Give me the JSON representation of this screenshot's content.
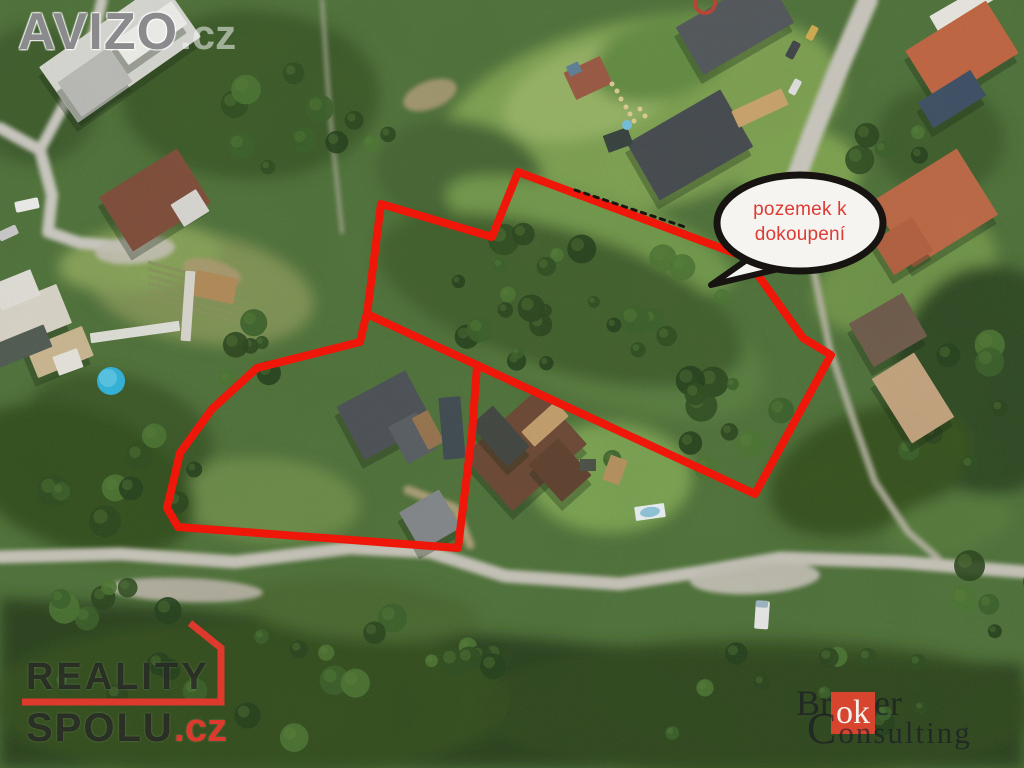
{
  "image": {
    "width": 1024,
    "height": 768,
    "description": "Aerial photo of land parcels for sale"
  },
  "callout": {
    "line1": "pozemek k",
    "line2": "dokoupení",
    "text_color": "#dc3c33",
    "fill": "#f6f4f1",
    "border_color": "#161311",
    "ellipse": [
      800,
      223,
      83,
      48
    ],
    "tail": [
      [
        748,
        259
      ],
      [
        711,
        285
      ],
      [
        783,
        268
      ]
    ]
  },
  "annotation": {
    "outline_color": "#ee1709",
    "outline_width": 8,
    "upper_parcel": [
      [
        518,
        172
      ],
      [
        745,
        257
      ],
      [
        803,
        338
      ],
      [
        831,
        355
      ],
      [
        755,
        494
      ],
      [
        367,
        314
      ],
      [
        381,
        204
      ],
      [
        492,
        237
      ]
    ],
    "lower_parcel": [
      [
        366,
        316
      ],
      [
        360,
        342
      ],
      [
        257,
        368
      ],
      [
        212,
        409
      ],
      [
        180,
        453
      ],
      [
        167,
        508
      ],
      [
        178,
        527
      ],
      [
        458,
        548
      ],
      [
        472,
        434
      ],
      [
        477,
        366
      ]
    ],
    "boundary_ticks": {
      "points": [
        [
          575,
          190
        ],
        [
          688,
          228
        ]
      ],
      "color": "#1a1712"
    }
  },
  "watermarks": {
    "avizo": {
      "name": "AVIZO",
      "tld": ".cz"
    },
    "reality_spolu": {
      "line1": "REALITY",
      "line2": "SPOLU",
      "tld": ".cz",
      "accent": "#dd392c",
      "mark": [
        [
          190,
          623
        ],
        [
          221,
          648
        ],
        [
          221,
          702
        ],
        [
          22,
          702
        ]
      ]
    },
    "broker_consulting": {
      "pre": "Br",
      "highlight": "ok",
      "post": "er",
      "line2_initial": "C",
      "line2_rest": "onsulting",
      "box_color": "#d7452f"
    }
  },
  "scene": {
    "base": "#4e7138",
    "tree_palette": [
      "#24401b",
      "#2d4d1f",
      "#3a5f28",
      "#4a7331",
      "#2a451d"
    ],
    "tree_highlight": "#5d8038",
    "blobs": [
      {
        "e": [
          640,
          115,
          205,
          95,
          -12
        ],
        "c": "#7ca04f"
      },
      {
        "e": [
          595,
          90,
          95,
          45,
          -18
        ],
        "c": "#95b264"
      },
      {
        "e": [
          250,
          95,
          130,
          85,
          0
        ],
        "c": "#3b5a28"
      },
      {
        "e": [
          35,
          95,
          65,
          70,
          0
        ],
        "c": "#3d5c2a"
      },
      {
        "e": [
          460,
          175,
          85,
          55,
          10
        ],
        "c": "#456530"
      },
      {
        "e": [
          590,
          235,
          150,
          42,
          17
        ],
        "c": "#6f9749"
      },
      {
        "e": [
          600,
          330,
          175,
          72,
          20
        ],
        "c": "#567b3c"
      },
      {
        "e": [
          560,
          300,
          190,
          70,
          17
        ],
        "c": "#3f5f2a"
      },
      {
        "e": [
          610,
          478,
          82,
          55,
          0
        ],
        "c": "#79a150"
      },
      {
        "e": [
          905,
          275,
          95,
          52,
          -20
        ],
        "c": "#6e9346"
      },
      {
        "e": [
          800,
          175,
          60,
          45,
          -10
        ],
        "c": "#7ba14e"
      },
      {
        "e": [
          200,
          288,
          115,
          55,
          10
        ],
        "c": "#7e9252"
      },
      {
        "e": [
          140,
          258,
          82,
          32,
          -8
        ],
        "c": "#86a156"
      },
      {
        "e": [
          268,
          500,
          92,
          42,
          5
        ],
        "c": "#6b8b47"
      },
      {
        "e": [
          120,
          430,
          95,
          55,
          15
        ],
        "c": "#3a5826"
      },
      {
        "e": [
          80,
          480,
          120,
          70,
          20
        ],
        "c": "#33501f"
      },
      {
        "p": [
          [
            0,
            598
          ],
          [
            150,
            606
          ],
          [
            350,
            622
          ],
          [
            600,
            645
          ],
          [
            850,
            655
          ],
          [
            1024,
            665
          ],
          [
            1024,
            768
          ],
          [
            0,
            768
          ]
        ],
        "c": "#2b421f"
      },
      {
        "e": [
          250,
          700,
          260,
          80,
          0
        ],
        "c": "#35511f",
        "o": 0.75
      },
      {
        "e": [
          760,
          708,
          280,
          70,
          0
        ],
        "c": "#31491e",
        "o": 0.75
      },
      {
        "e": [
          990,
          380,
          95,
          115,
          0
        ],
        "c": "#2f4a20"
      },
      {
        "e": [
          870,
          470,
          105,
          60,
          -20
        ],
        "c": "#34511f"
      },
      {
        "e": [
          940,
          140,
          65,
          55,
          0
        ],
        "c": "#3e5d2a"
      },
      {
        "e": [
          660,
          60,
          70,
          40,
          -15
        ],
        "c": "#628b41"
      },
      {
        "e": [
          950,
          525,
          65,
          28,
          -12
        ],
        "c": "#55793a"
      },
      {
        "e": [
          360,
          610,
          120,
          30,
          5
        ],
        "c": "#49682f"
      }
    ],
    "roads": [
      {
        "pts": [
          [
            0,
            557
          ],
          [
            120,
            554
          ],
          [
            235,
            562
          ],
          [
            350,
            548
          ],
          [
            430,
            552
          ],
          [
            505,
            576
          ],
          [
            620,
            584
          ],
          [
            700,
            572
          ],
          [
            780,
            558
          ],
          [
            900,
            562
          ],
          [
            1024,
            572
          ]
        ],
        "w": 13,
        "c": "#c6c3b8"
      },
      {
        "pts": [
          [
            0,
            128
          ],
          [
            40,
            150
          ],
          [
            52,
            195
          ],
          [
            48,
            232
          ],
          [
            80,
            243
          ],
          [
            140,
            248
          ]
        ],
        "w": 12,
        "c": "#cac8c0"
      },
      {
        "pts": [
          [
            40,
            150
          ],
          [
            72,
            90
          ],
          [
            95,
            30
          ],
          [
            102,
            0
          ]
        ],
        "w": 11,
        "c": "#cac8c0"
      },
      {
        "pts": [
          [
            868,
            0
          ],
          [
            838,
            70
          ],
          [
            812,
            135
          ],
          [
            795,
            182
          ]
        ],
        "w": 20,
        "c": "#c9c6bd"
      },
      {
        "pts": [
          [
            795,
            182
          ],
          [
            812,
            262
          ],
          [
            830,
            350
          ],
          [
            855,
            425
          ],
          [
            875,
            482
          ],
          [
            908,
            532
          ],
          [
            938,
            558
          ]
        ],
        "w": 7,
        "c": "#bcb6a8",
        "o": 0.85
      },
      {
        "pts": [
          [
            322,
            0
          ],
          [
            330,
            115
          ],
          [
            342,
            232
          ]
        ],
        "w": 4,
        "c": "#b5b1a4",
        "o": 0.7
      },
      {
        "pts": [
          [
            408,
            490
          ],
          [
            455,
            508
          ],
          [
            470,
            545
          ]
        ],
        "w": 9,
        "c": "#b3a17b",
        "o": 0.9
      }
    ],
    "dirt": [
      {
        "e": [
          185,
          590,
          78,
          12,
          2
        ],
        "c": "#b5b0a2",
        "o": 0.95
      },
      {
        "e": [
          755,
          578,
          65,
          16,
          -3
        ],
        "c": "#c1beb2",
        "o": 0.95
      },
      {
        "e": [
          430,
          95,
          28,
          14,
          -20
        ],
        "c": "#b59f79",
        "o": 0.8
      },
      {
        "e": [
          212,
          272,
          30,
          12,
          15
        ],
        "c": "#b09a72",
        "o": 0.8
      },
      {
        "e": [
          135,
          250,
          40,
          14,
          -5
        ],
        "c": "#c4c0b4",
        "o": 0.9
      }
    ],
    "field_rows": {
      "x": 148,
      "y": 262,
      "dx": 94,
      "dy": 26,
      "count": 6,
      "gap": 7,
      "c": "#87925a"
    },
    "structures": [
      [
        120,
        52,
        150,
        68,
        -35,
        "#d7d7d2"
      ],
      [
        95,
        82,
        62,
        42,
        -35,
        "#b9bab6"
      ],
      [
        150,
        33,
        72,
        28,
        -35,
        "#eeeeea"
      ],
      [
        155,
        200,
        92,
        64,
        -32,
        "#7e4c38"
      ],
      [
        190,
        208,
        30,
        26,
        -32,
        "#d9d7d2"
      ],
      [
        588,
        78,
        40,
        30,
        -25,
        "#995841"
      ],
      [
        574,
        69,
        13,
        11,
        -25,
        "#5e7f96"
      ],
      [
        690,
        145,
        108,
        66,
        -30,
        "#44494d"
      ],
      [
        735,
        25,
        105,
        55,
        -30,
        "#51565a"
      ],
      [
        965,
        6,
        72,
        18,
        -30,
        "#e8e6df"
      ],
      [
        962,
        52,
        95,
        62,
        -32,
        "#c06440"
      ],
      [
        952,
        99,
        62,
        30,
        -32,
        "#3c4e63"
      ],
      [
        935,
        208,
        100,
        78,
        -32,
        "#bb6743"
      ],
      [
        903,
        246,
        46,
        40,
        -32,
        "#b25f3e"
      ],
      [
        888,
        330,
        62,
        50,
        -30,
        "#6e5a49"
      ],
      [
        913,
        398,
        50,
        76,
        -32,
        "#c2a27c"
      ],
      [
        385,
        415,
        78,
        60,
        -28,
        "#4b5054"
      ],
      [
        412,
        438,
        32,
        42,
        -28,
        "#585d61"
      ],
      [
        428,
        430,
        18,
        36,
        -28,
        "#96734e"
      ],
      [
        452,
        428,
        22,
        62,
        -5,
        "#3e4a50"
      ],
      [
        430,
        520,
        46,
        44,
        -30,
        "#818689"
      ],
      [
        525,
        450,
        100,
        74,
        -42,
        "#6b4733"
      ],
      [
        560,
        470,
        40,
        50,
        -42,
        "#5f3f2d"
      ],
      [
        545,
        424,
        46,
        20,
        -42,
        "#c39d6a"
      ],
      [
        500,
        436,
        30,
        55,
        -42,
        "#41453f"
      ],
      [
        28,
        318,
        78,
        42,
        -22,
        "#d9d4c7"
      ],
      [
        60,
        352,
        60,
        32,
        -22,
        "#c9b68f"
      ],
      [
        16,
        290,
        42,
        28,
        -22,
        "#e0ded6"
      ],
      [
        22,
        346,
        56,
        24,
        -22,
        "#4f5a50"
      ],
      [
        215,
        287,
        42,
        26,
        12,
        "#b08a57"
      ],
      [
        68,
        362,
        26,
        20,
        -20,
        "#e4e2da"
      ],
      [
        135,
        332,
        90,
        10,
        -8,
        "#dfe0d8"
      ],
      [
        188,
        306,
        10,
        70,
        4,
        "#d8d6cc"
      ],
      [
        615,
        470,
        18,
        26,
        20,
        "#b5915c"
      ],
      [
        618,
        140,
        26,
        18,
        -20,
        "#35403c"
      ],
      [
        588,
        465,
        16,
        12,
        0,
        "#4a4f45"
      ],
      [
        760,
        108,
        55,
        18,
        -25,
        "#c9a36b"
      ],
      [
        650,
        512,
        30,
        14,
        -8,
        "#e9f0f2"
      ]
    ],
    "cars": [
      [
        27,
        205,
        24,
        11,
        -12,
        "#ececea"
      ],
      [
        8,
        233,
        20,
        10,
        -25,
        "#c9c9c9"
      ],
      [
        793,
        50,
        18,
        9,
        -62,
        "#3f4448"
      ],
      [
        812,
        33,
        15,
        8,
        -62,
        "#cfa94e"
      ],
      [
        795,
        87,
        16,
        8,
        -62,
        "#e2e2e0"
      ],
      [
        762,
        615,
        14,
        28,
        4,
        "#e6e7e6"
      ],
      [
        762,
        604,
        12,
        7,
        4,
        "#9db4c4"
      ]
    ],
    "pools": [
      {
        "e": [
          111,
          381,
          14,
          14,
          0
        ],
        "c": "#2fb2d9"
      },
      {
        "e": [
          108,
          378,
          9,
          9,
          0
        ],
        "c": "#55c3e2"
      },
      {
        "e": [
          627,
          125,
          5,
          5,
          0
        ],
        "c": "#74bedd"
      },
      {
        "e": [
          650,
          512,
          10,
          5,
          -8
        ],
        "c": "#8fc3d8"
      }
    ],
    "stepping_stones": [
      [
        612,
        84
      ],
      [
        617,
        91
      ],
      [
        621,
        99
      ],
      [
        626,
        107
      ],
      [
        630,
        114
      ],
      [
        634,
        121
      ],
      [
        640,
        109
      ],
      [
        645,
        116
      ]
    ],
    "trampoline_ring": [
      705,
      3,
      10
    ],
    "tree_clusters": [
      {
        "cx": 560,
        "cy": 298,
        "rx": 185,
        "ry": 68,
        "n": 26
      },
      {
        "cx": 300,
        "cy": 125,
        "rx": 95,
        "ry": 65,
        "n": 12
      },
      {
        "cx": 690,
        "cy": 425,
        "rx": 115,
        "ry": 55,
        "n": 11
      },
      {
        "cx": 140,
        "cy": 470,
        "rx": 105,
        "ry": 55,
        "n": 9
      },
      {
        "cx": 945,
        "cy": 395,
        "rx": 65,
        "ry": 85,
        "n": 9
      },
      {
        "cx": 300,
        "cy": 690,
        "rx": 270,
        "ry": 58,
        "n": 16
      },
      {
        "cx": 800,
        "cy": 700,
        "rx": 195,
        "ry": 52,
        "n": 12
      },
      {
        "cx": 85,
        "cy": 618,
        "rx": 85,
        "ry": 38,
        "n": 7
      },
      {
        "cx": 460,
        "cy": 640,
        "rx": 90,
        "ry": 40,
        "n": 7
      },
      {
        "cx": 230,
        "cy": 350,
        "rx": 60,
        "ry": 40,
        "n": 6
      },
      {
        "cx": 875,
        "cy": 135,
        "rx": 50,
        "ry": 45,
        "n": 5
      },
      {
        "cx": 990,
        "cy": 600,
        "rx": 60,
        "ry": 40,
        "n": 5
      }
    ]
  }
}
